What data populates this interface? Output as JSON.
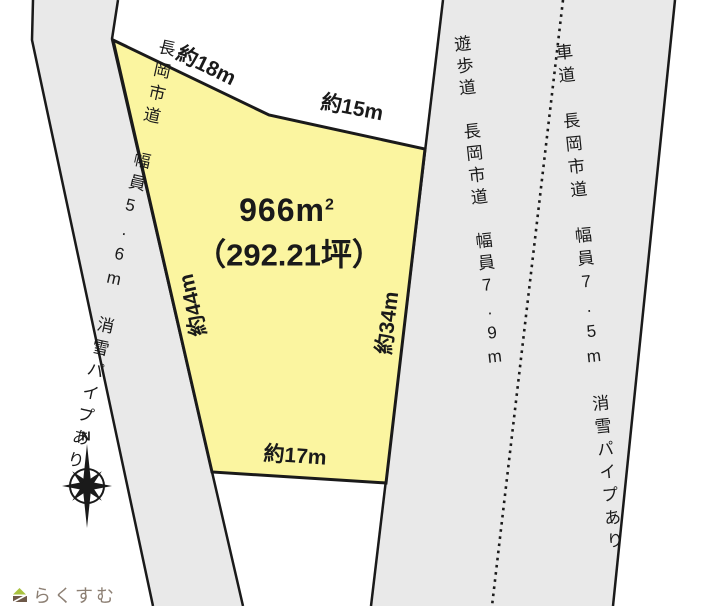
{
  "plot": {
    "area_label": "966m",
    "area_superscript": "2",
    "area_tsubo": "（292.21坪）",
    "fill_color": "#FBF5A0",
    "dimensions": {
      "top_left": "約18m",
      "top_right": "約15m",
      "left": "約44m",
      "right": "約34m",
      "bottom": "約17m"
    }
  },
  "roads": {
    "fill_color": "#E9E9E9",
    "left_road": {
      "label": "長岡市道　幅員5.6m　消雪パイプあり"
    },
    "promenade": {
      "label": "遊歩道　長岡市道　幅員7.9m"
    },
    "vehicle_road": {
      "label": "車道　長岡市道　幅員7.5m　消雪パイプあり"
    }
  },
  "compass": {
    "north_label": "N"
  },
  "watermark": {
    "text": "らくすむ",
    "text_color": "#8C7F73",
    "logo_green": "#A9C23F",
    "logo_brown": "#6E5949"
  },
  "colors": {
    "line": "#1A1A1A",
    "background": "#FFFFFF"
  }
}
